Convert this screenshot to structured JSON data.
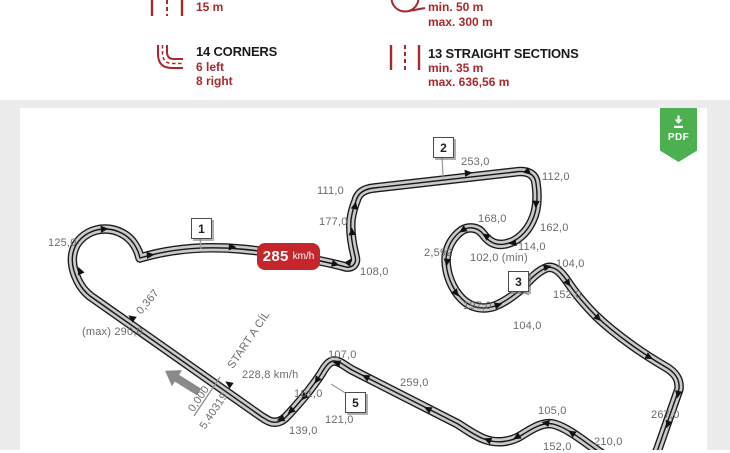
{
  "header": {
    "accent_color": "#a8292d",
    "stats": [
      {
        "icon": "track-width-icon",
        "value_lines": [
          "15 m"
        ]
      },
      {
        "icon": "turn-radius-icon",
        "value_lines": [
          "min. 50 m",
          "max. 300 m"
        ]
      },
      {
        "icon": "corner-icon",
        "title": "14 CORNERS",
        "value_lines": [
          "6 left",
          "8 right"
        ]
      },
      {
        "icon": "straight-sections-icon",
        "title": "13 STRAIGHT SECTIONS",
        "value_lines": [
          "min. 35 m",
          "max. 636,56 m"
        ]
      }
    ]
  },
  "map": {
    "label_color": "#6b6b6b",
    "track_fill": "#cacaca",
    "track_outline": "#1a1a1a",
    "pdf_button": {
      "label": "PDF",
      "icon": "download-icon",
      "color": "#4caf50"
    },
    "speed_badge": {
      "value": "285",
      "unit": "km/h",
      "color": "#c4262c"
    },
    "corner_markers": [
      {
        "label": "1",
        "x": 191,
        "y": 218
      },
      {
        "label": "2",
        "x": 433,
        "y": 137
      },
      {
        "label": "3",
        "x": 508,
        "y": 271
      },
      {
        "label": "5",
        "x": 345,
        "y": 392
      }
    ],
    "labels": [
      {
        "text": "125,0",
        "x": 48,
        "y": 237
      },
      {
        "text": "111,0",
        "x": 317,
        "y": 185
      },
      {
        "text": "177,0",
        "x": 319,
        "y": 216
      },
      {
        "text": "253,0",
        "x": 461,
        "y": 156
      },
      {
        "text": "112,0",
        "x": 542,
        "y": 171
      },
      {
        "text": "168,0",
        "x": 478,
        "y": 213
      },
      {
        "text": "162,0",
        "x": 540,
        "y": 222
      },
      {
        "text": "114,0",
        "x": 518,
        "y": 241
      },
      {
        "text": "102,0 (min)",
        "x": 470,
        "y": 252
      },
      {
        "text": "2,592",
        "x": 424,
        "y": 247
      },
      {
        "text": "104,0",
        "x": 556,
        "y": 258
      },
      {
        "text": "152,0",
        "x": 553,
        "y": 289
      },
      {
        "text": "197,0",
        "x": 463,
        "y": 300
      },
      {
        "text": "104,0",
        "x": 513,
        "y": 320
      },
      {
        "text": "108,0",
        "x": 360,
        "y": 266
      },
      {
        "text": "(max) 290,0",
        "x": 82,
        "y": 326
      },
      {
        "text": "228,8 km/h",
        "x": 242,
        "y": 369
      },
      {
        "text": "107,0",
        "x": 328,
        "y": 349
      },
      {
        "text": "259,0",
        "x": 400,
        "y": 377
      },
      {
        "text": "161,0",
        "x": 294,
        "y": 388
      },
      {
        "text": "121,0",
        "x": 325,
        "y": 414
      },
      {
        "text": "139,0",
        "x": 289,
        "y": 425
      },
      {
        "text": "105,0",
        "x": 538,
        "y": 405
      },
      {
        "text": "152,0",
        "x": 543,
        "y": 441
      },
      {
        "text": "210,0",
        "x": 594,
        "y": 436
      },
      {
        "text": "267,0",
        "x": 651,
        "y": 409
      }
    ],
    "rotated_labels": [
      {
        "text": "START A CÍL",
        "x": 249,
        "y": 340,
        "rot": -56
      },
      {
        "text": "0,000",
        "x": 199,
        "y": 399,
        "rot": -56
      },
      {
        "text": "5,40319",
        "x": 214,
        "y": 411,
        "rot": -56
      },
      {
        "text": "0,367",
        "x": 148,
        "y": 302,
        "rot": -50
      }
    ]
  }
}
